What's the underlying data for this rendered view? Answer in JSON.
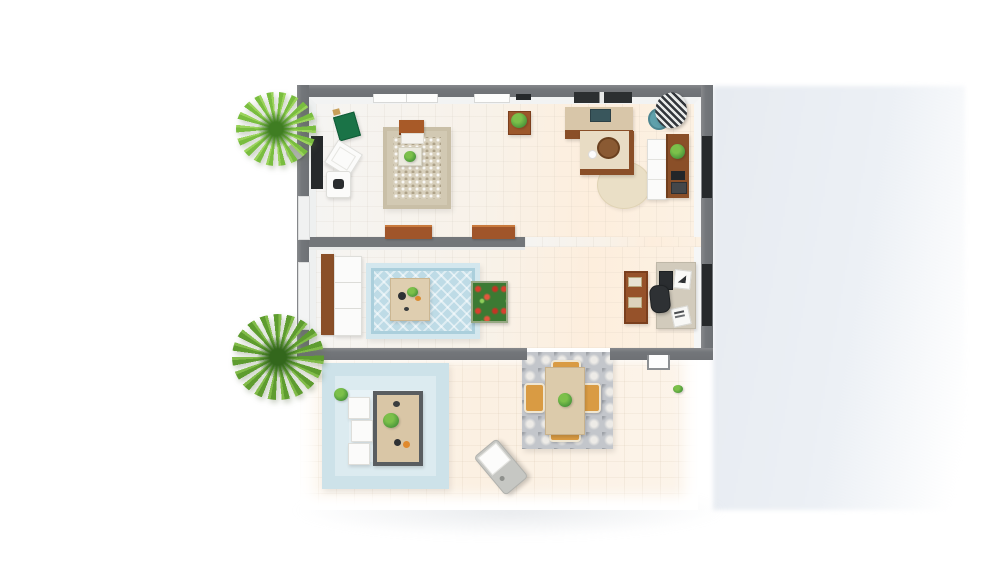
{
  "scene": {
    "title": "3D floor plan - top-down view",
    "type": "3d-architectural-floor-plan-render",
    "view": "top-down",
    "background_color": "#ffffff",
    "text_visible": "none"
  },
  "palette": {
    "wall_gray": "#73767a",
    "floor_cool": "#f5f4f2",
    "floor_warm": "#fdeedd",
    "patio_tile": "#fbf0e2",
    "pool_rug_blue": "#cde2e9",
    "blue_rug": "#bedbe6",
    "area_rug_beige": "#d7cfbb",
    "dining_rug_gray": "#c3c6cb",
    "wood_brown": "#8a4f28",
    "counter_beige": "#d8c6a9",
    "stove_teal": "#39565c",
    "bench_green": "#1a7347",
    "plant_green": "#4e9a3c",
    "palm_green": "#79bd3f",
    "pot_teal": "#5fa0ab",
    "chair_tan": "#d99b43",
    "dark_window": "#26292b",
    "white_furniture": "#fbfbfa",
    "ground_shadow": "#e7ebf1"
  },
  "rooms": {
    "living": {
      "label": "living room and kitchen-dining area"
    },
    "lounge": {
      "label": "lounge room with home-office corner"
    },
    "patio": {
      "label": "outdoor patio with pool rug and dining set"
    }
  },
  "inventory": {
    "living_room": [
      "wall tv",
      "green bench",
      "white armchair",
      "side table with figure",
      "speckled area rug",
      "wood bench with cushion",
      "coffee table with plant",
      "plant stand",
      "kitchen counter with stove",
      "kitchen island with stool",
      "round rug",
      "white cabinet",
      "wall console with plant and books",
      "zebra-leaf plant in teal pot"
    ],
    "lounge_room": [
      "white sofa with wood back",
      "blue patterned rug",
      "square table with food",
      "flower box",
      "bookshelf",
      "desk with laptop and papers",
      "black desk chair"
    ],
    "patio": [
      "light-blue outdoor rug",
      "framed patio table with plants",
      "three white cube seats",
      "small potted plant",
      "gray damask dining rug",
      "dining table",
      "four tan chairs",
      "centerpiece plant",
      "gray lounge chair",
      "door threshold step",
      "small green sprig"
    ],
    "outside": [
      "palm tree north",
      "palm tree south",
      "ground shadow plane"
    ]
  }
}
